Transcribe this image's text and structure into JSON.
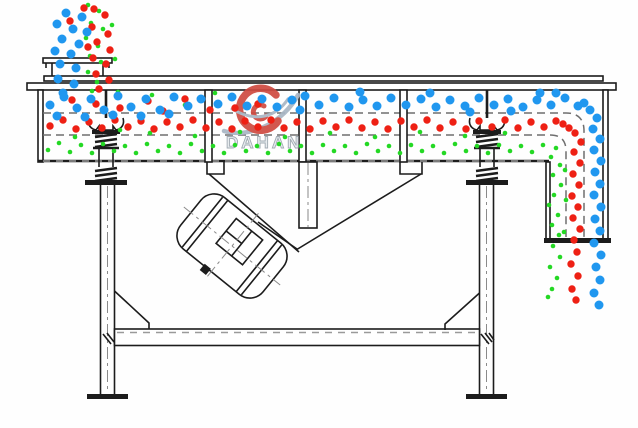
{
  "watermark": {
    "brand": "DAHAN",
    "registered": "®"
  },
  "colors": {
    "line": "#1c1c1c",
    "guide_dash": "#6f6f6f",
    "coarse_blue": "#2097ef",
    "medium_red": "#ee2014",
    "fine_green": "#24d824",
    "watermark_text_fill": "#e7ebee",
    "watermark_text_stroke": "#9aa4ad",
    "watermark_swirl": "#cf4a41",
    "watermark_swoosh": "#a9b6c4"
  },
  "particles": {
    "green": {
      "color": "#24d824",
      "r": 2.3,
      "points": [
        [
          88,
          5
        ],
        [
          99,
          11
        ],
        [
          91,
          23
        ],
        [
          103,
          29
        ],
        [
          86,
          38
        ],
        [
          98,
          46
        ],
        [
          90,
          56
        ],
        [
          101,
          62
        ],
        [
          88,
          72
        ],
        [
          97,
          82
        ],
        [
          92,
          91
        ],
        [
          112,
          25
        ],
        [
          115,
          59
        ],
        [
          118,
          92
        ],
        [
          152,
          95
        ],
        [
          185,
          105
        ],
        [
          215,
          93
        ],
        [
          120,
          130
        ],
        [
          75,
          137
        ],
        [
          150,
          133
        ],
        [
          195,
          136
        ],
        [
          240,
          132
        ],
        [
          285,
          137
        ],
        [
          330,
          133
        ],
        [
          375,
          137
        ],
        [
          420,
          132
        ],
        [
          465,
          136
        ],
        [
          505,
          133
        ],
        [
          48,
          150
        ],
        [
          59,
          143
        ],
        [
          70,
          152
        ],
        [
          81,
          145
        ],
        [
          92,
          153
        ],
        [
          103,
          144
        ],
        [
          114,
          151
        ],
        [
          125,
          146
        ],
        [
          136,
          153
        ],
        [
          147,
          144
        ],
        [
          158,
          151
        ],
        [
          169,
          146
        ],
        [
          180,
          153
        ],
        [
          191,
          144
        ],
        [
          202,
          151
        ],
        [
          213,
          146
        ],
        [
          224,
          153
        ],
        [
          235,
          145
        ],
        [
          246,
          151
        ],
        [
          257,
          146
        ],
        [
          268,
          153
        ],
        [
          279,
          144
        ],
        [
          290,
          151
        ],
        [
          301,
          146
        ],
        [
          312,
          153
        ],
        [
          323,
          145
        ],
        [
          334,
          151
        ],
        [
          345,
          146
        ],
        [
          356,
          153
        ],
        [
          367,
          144
        ],
        [
          378,
          151
        ],
        [
          389,
          146
        ],
        [
          400,
          153
        ],
        [
          411,
          145
        ],
        [
          422,
          151
        ],
        [
          433,
          146
        ],
        [
          444,
          153
        ],
        [
          455,
          144
        ],
        [
          466,
          151
        ],
        [
          477,
          146
        ],
        [
          488,
          153
        ],
        [
          499,
          145
        ],
        [
          510,
          151
        ],
        [
          521,
          146
        ],
        [
          532,
          152
        ],
        [
          543,
          145
        ],
        [
          556,
          148
        ],
        [
          551,
          157
        ],
        [
          560,
          165
        ],
        [
          553,
          175
        ],
        [
          561,
          185
        ],
        [
          554,
          195
        ],
        [
          549,
          205
        ],
        [
          558,
          215
        ],
        [
          552,
          225
        ],
        [
          559,
          235
        ],
        [
          553,
          246
        ],
        [
          560,
          257
        ],
        [
          550,
          267
        ],
        [
          557,
          278
        ],
        [
          552,
          289
        ],
        [
          565,
          170
        ],
        [
          566,
          200
        ],
        [
          564,
          232
        ],
        [
          548,
          297
        ]
      ]
    },
    "red": {
      "color": "#ee2014",
      "r": 3.7,
      "points": [
        [
          94,
          9
        ],
        [
          105,
          15
        ],
        [
          92,
          27
        ],
        [
          108,
          34
        ],
        [
          97,
          42
        ],
        [
          110,
          50
        ],
        [
          93,
          58
        ],
        [
          106,
          64
        ],
        [
          96,
          74
        ],
        [
          109,
          80
        ],
        [
          99,
          89
        ],
        [
          84,
          8
        ],
        [
          70,
          21
        ],
        [
          88,
          47
        ],
        [
          72,
          100
        ],
        [
          96,
          104
        ],
        [
          120,
          108
        ],
        [
          148,
          101
        ],
        [
          163,
          111
        ],
        [
          185,
          99
        ],
        [
          210,
          110
        ],
        [
          235,
          108
        ],
        [
          258,
          104
        ],
        [
          50,
          126
        ],
        [
          63,
          120
        ],
        [
          76,
          129
        ],
        [
          89,
          122
        ],
        [
          102,
          128
        ],
        [
          115,
          120
        ],
        [
          128,
          127
        ],
        [
          141,
          121
        ],
        [
          154,
          129
        ],
        [
          167,
          122
        ],
        [
          180,
          127
        ],
        [
          193,
          120
        ],
        [
          206,
          128
        ],
        [
          219,
          122
        ],
        [
          232,
          129
        ],
        [
          245,
          121
        ],
        [
          258,
          127
        ],
        [
          271,
          120
        ],
        [
          284,
          128
        ],
        [
          297,
          122
        ],
        [
          310,
          129
        ],
        [
          323,
          121
        ],
        [
          336,
          127
        ],
        [
          349,
          120
        ],
        [
          362,
          128
        ],
        [
          375,
          122
        ],
        [
          388,
          129
        ],
        [
          401,
          121
        ],
        [
          414,
          127
        ],
        [
          427,
          120
        ],
        [
          440,
          128
        ],
        [
          453,
          122
        ],
        [
          466,
          129
        ],
        [
          479,
          121
        ],
        [
          492,
          127
        ],
        [
          505,
          120
        ],
        [
          518,
          128
        ],
        [
          531,
          122
        ],
        [
          544,
          127
        ],
        [
          556,
          121
        ],
        [
          563,
          124
        ],
        [
          569,
          128
        ],
        [
          575,
          133
        ],
        [
          581,
          142
        ],
        [
          574,
          152
        ],
        [
          580,
          163
        ],
        [
          573,
          174
        ],
        [
          579,
          185
        ],
        [
          572,
          196
        ],
        [
          578,
          207
        ],
        [
          573,
          218
        ],
        [
          580,
          229
        ],
        [
          574,
          240
        ],
        [
          577,
          252
        ],
        [
          571,
          264
        ],
        [
          578,
          276
        ],
        [
          572,
          289
        ],
        [
          576,
          300
        ]
      ]
    },
    "blue": {
      "color": "#2097ef",
      "r": 4.5,
      "points": [
        [
          66,
          13
        ],
        [
          82,
          17
        ],
        [
          57,
          24
        ],
        [
          73,
          29
        ],
        [
          87,
          32
        ],
        [
          62,
          39
        ],
        [
          79,
          44
        ],
        [
          55,
          51
        ],
        [
          71,
          54
        ],
        [
          60,
          64
        ],
        [
          76,
          68
        ],
        [
          58,
          79
        ],
        [
          74,
          84
        ],
        [
          63,
          93
        ],
        [
          50,
          105
        ],
        [
          64,
          97
        ],
        [
          77,
          108
        ],
        [
          91,
          99
        ],
        [
          104,
          110
        ],
        [
          118,
          96
        ],
        [
          131,
          107
        ],
        [
          146,
          99
        ],
        [
          160,
          110
        ],
        [
          174,
          97
        ],
        [
          188,
          106
        ],
        [
          57,
          116
        ],
        [
          85,
          117
        ],
        [
          113,
          115
        ],
        [
          141,
          116
        ],
        [
          169,
          114
        ],
        [
          201,
          99
        ],
        [
          218,
          104
        ],
        [
          232,
          97
        ],
        [
          247,
          106
        ],
        [
          262,
          99
        ],
        [
          277,
          107
        ],
        [
          292,
          100
        ],
        [
          305,
          96
        ],
        [
          319,
          105
        ],
        [
          334,
          98
        ],
        [
          349,
          107
        ],
        [
          363,
          100
        ],
        [
          377,
          106
        ],
        [
          391,
          98
        ],
        [
          406,
          105
        ],
        [
          421,
          99
        ],
        [
          436,
          107
        ],
        [
          450,
          100
        ],
        [
          465,
          106
        ],
        [
          479,
          98
        ],
        [
          494,
          105
        ],
        [
          508,
          99
        ],
        [
          523,
          107
        ],
        [
          537,
          100
        ],
        [
          551,
          105
        ],
        [
          565,
          98
        ],
        [
          578,
          106
        ],
        [
          300,
          110
        ],
        [
          360,
          92
        ],
        [
          430,
          93
        ],
        [
          470,
          112
        ],
        [
          540,
          93
        ],
        [
          511,
          111
        ],
        [
          556,
          93
        ],
        [
          584,
          103
        ],
        [
          590,
          110
        ],
        [
          597,
          118
        ],
        [
          593,
          129
        ],
        [
          600,
          139
        ],
        [
          594,
          150
        ],
        [
          601,
          161
        ],
        [
          595,
          172
        ],
        [
          600,
          184
        ],
        [
          594,
          195
        ],
        [
          601,
          207
        ],
        [
          595,
          219
        ],
        [
          600,
          231
        ],
        [
          594,
          243
        ],
        [
          601,
          255
        ],
        [
          596,
          267
        ],
        [
          600,
          280
        ],
        [
          594,
          293
        ],
        [
          599,
          305
        ]
      ]
    }
  }
}
